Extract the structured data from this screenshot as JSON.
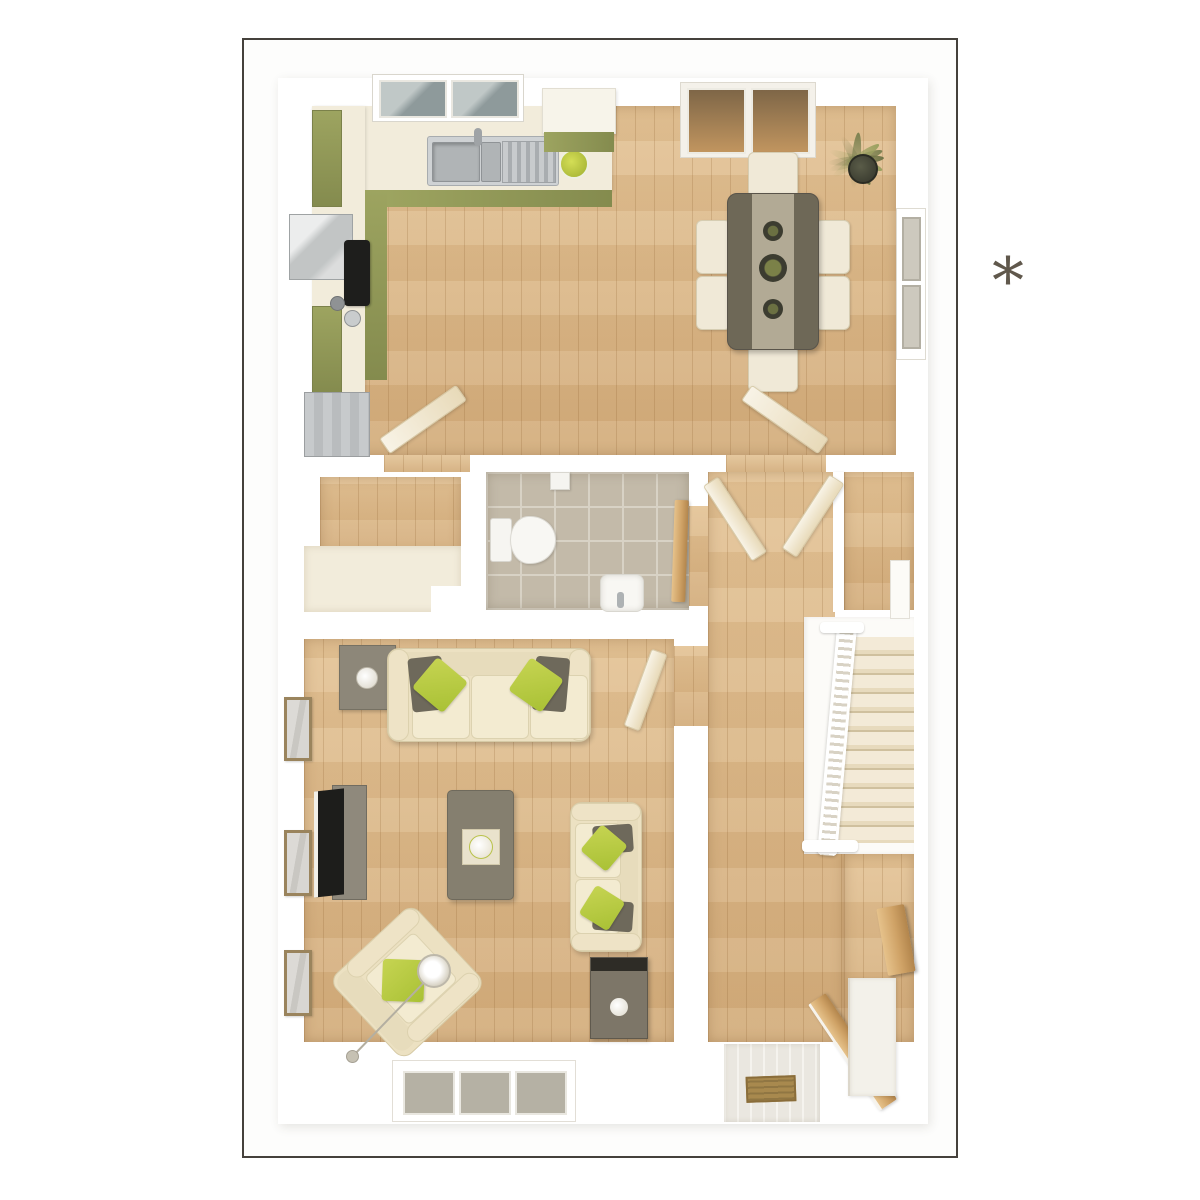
{
  "footnote": {
    "symbol": "*"
  },
  "palette": {
    "frame_border": "#45413c",
    "wall_white": "#ffffff",
    "wood_a": "#e4c497",
    "wood_b": "#d3ad7c",
    "olive": "#9da460",
    "olive_dark": "#848b4e",
    "counter_cream": "#f2ecdb",
    "chair_cream": "#f0e9d7",
    "sofa_cream": "#ece1c2",
    "cushion_cream": "#f3ebd1",
    "pillow_green": "#a9c135",
    "pillow_taupe": "#6e695b",
    "table_dark": "#6e6857",
    "runner": "#b2aa95",
    "tile": "#c3baa9",
    "tile_line": "#d8d2c5",
    "carpet_light": "#f3ead7",
    "carpet_mid": "#e7dabd",
    "carpet_dark": "#cfc09e",
    "wood_door": "#cfa266",
    "glass_cool": "#8e9a9b",
    "glass_warm_a": "#7e6647",
    "glass_warm_b": "#c1955f",
    "photo_frame": "#9a845d",
    "appliance_gray": "#b9bcbe",
    "hob_black": "#1e1e1c",
    "asterisk_color": "#60584c"
  }
}
